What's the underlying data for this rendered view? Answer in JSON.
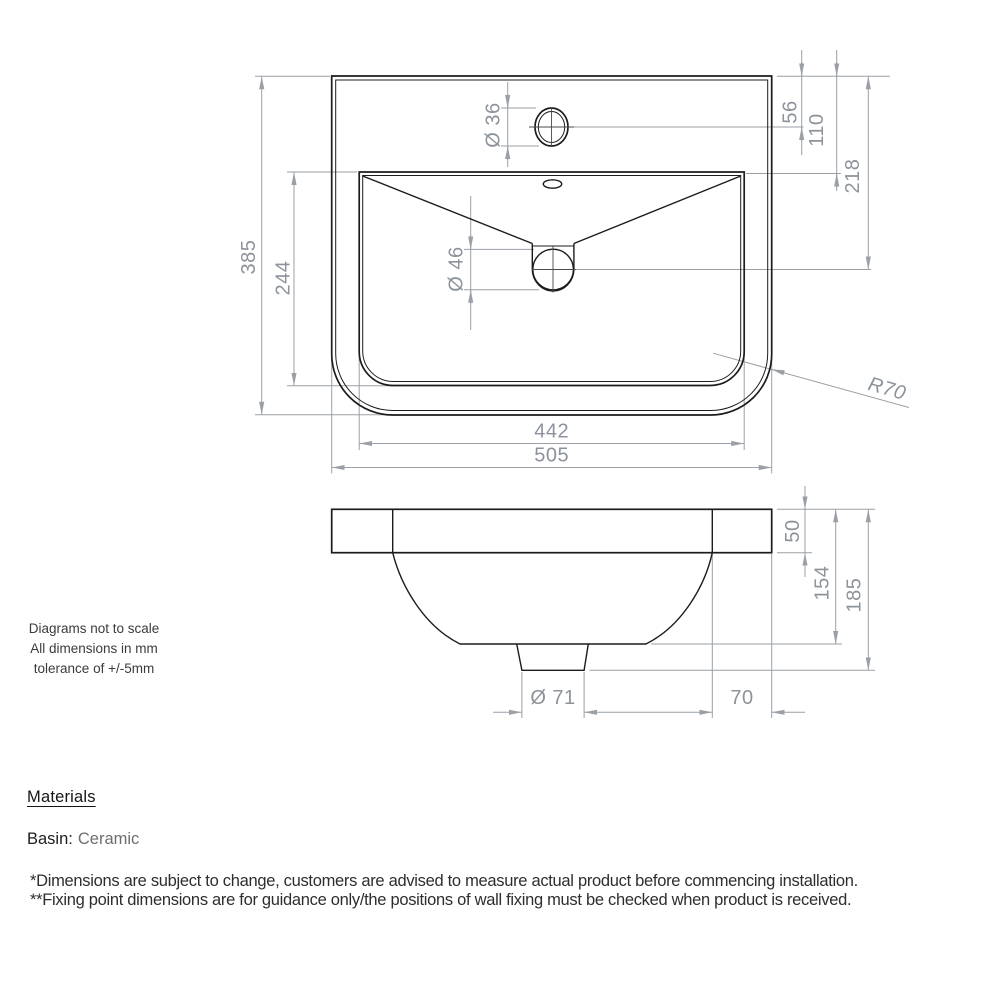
{
  "notes": {
    "lines": [
      "Diagrams not to scale",
      "All dimensions in mm",
      "tolerance of +/-5mm"
    ]
  },
  "top_view": {
    "dims": {
      "overall_width": "505",
      "basin_width": "442",
      "overall_depth": "385",
      "basin_depth": "244",
      "tap_hole_dia": "Ø 36",
      "waste_dia": "Ø 46",
      "top_edge_to_tap_centre": "56",
      "top_edge_to_basin": "110",
      "top_edge_to_waste_centre": "218",
      "corner_radius": "R70"
    }
  },
  "side_view": {
    "dims": {
      "rim_height": "50",
      "depth_to_bowl_base": "154",
      "overall_height": "185",
      "waste_outlet_dia": "Ø 71",
      "back_ledge_width": "70"
    }
  },
  "materials": {
    "heading": "Materials",
    "items": [
      {
        "label": "Basin:",
        "value": "Ceramic"
      }
    ]
  },
  "footnotes": [
    "*Dimensions are subject to change, customers are advised to measure actual product before commencing installation.",
    "**Fixing point dimensions are for guidance only/the positions of wall fixing must be checked when product is received."
  ],
  "colors": {
    "geometry_line": "#1c1c1c",
    "dimension_line": "#9aa0a6",
    "dimension_text": "#8d939b",
    "note_text": "#3b3b3b",
    "body_text": "#1d1d1d"
  }
}
